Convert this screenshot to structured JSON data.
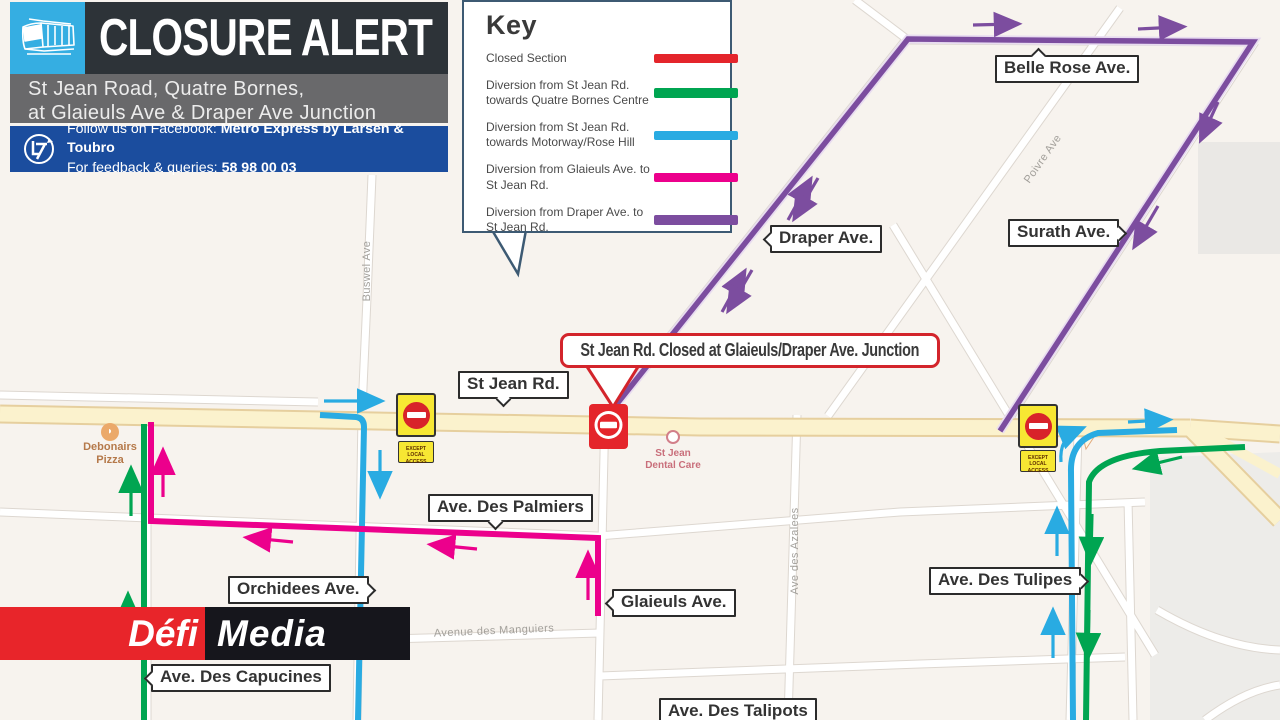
{
  "header": {
    "title": "CLOSURE ALERT",
    "subtitle_line1": "St Jean Road, Quatre Bornes,",
    "subtitle_line2": "at Glaieuls Ave & Draper Ave Junction",
    "facebook_prefix": "Follow us on Facebook: ",
    "facebook_bold": "Metro Express by Larsen & Toubro",
    "queries_prefix": "For feedback & queries: ",
    "queries_bold": "58 98 00 03",
    "tram_icon": "tram-icon",
    "lt_logo_icon": "larsen-toubro-logo"
  },
  "legend": {
    "title": "Key",
    "items": [
      {
        "label": "Closed Section",
        "color": "#e4252b"
      },
      {
        "label": "Diversion from St Jean Rd. towards Quatre Bornes Centre",
        "color": "#00a551"
      },
      {
        "label": "Diversion from St Jean Rd. towards Motorway/Rose Hill",
        "color": "#29abe2"
      },
      {
        "label": "Diversion from Glaieuls Ave. to St Jean Rd.",
        "color": "#ec008c"
      },
      {
        "label": "Diversion from Draper Ave. to St Jean Rd.",
        "color": "#7c4d9f"
      }
    ]
  },
  "alert_callout": {
    "text": "St Jean Rd. Closed at Glaieuls/Draper Ave. Junction"
  },
  "map": {
    "street_labels": {
      "belle_rose": "Belle Rose Ave.",
      "draper": "Draper Ave.",
      "surath": "Surath Ave.",
      "st_jean": "St Jean Rd.",
      "palmiers": "Ave. Des Palmiers",
      "orchidees": "Orchidees Ave.",
      "glaieuls": "Glaieuls Ave.",
      "tulipes": "Ave. Des Tulipes",
      "capucines": "Ave. Des Capucines",
      "talipots": "Ave. Des Talipots"
    },
    "minor_streets": {
      "buswel": "Buswel Ave",
      "poivre": "Poivre Ave",
      "azalees": "Ave des Azalees",
      "manguiers": "Avenue des Manguiers"
    },
    "pois": {
      "debonairs_line1": "Debonairs",
      "debonairs_line2": "Pizza",
      "dental_line1": "St Jean",
      "dental_line2": "Dental Care"
    },
    "signs": {
      "exception_line1": "EXCEPT LOCAL",
      "exception_line2": "ACCESS"
    }
  },
  "branding": {
    "defi": "Défi",
    "media": "Media"
  },
  "colors": {
    "closed_red": "#e4252b",
    "diversion_green": "#00a551",
    "diversion_cyan": "#29abe2",
    "diversion_magenta": "#ec008c",
    "diversion_purple": "#7c4d9f",
    "brand_blue": "#1b4d9e",
    "header_dark": "#2d3338",
    "header_gray": "#69696b",
    "metro_cyan": "#35aee2",
    "road_yellow": "#fbf2cd",
    "defi_red": "#e8252a",
    "defi_black": "#16161c"
  }
}
